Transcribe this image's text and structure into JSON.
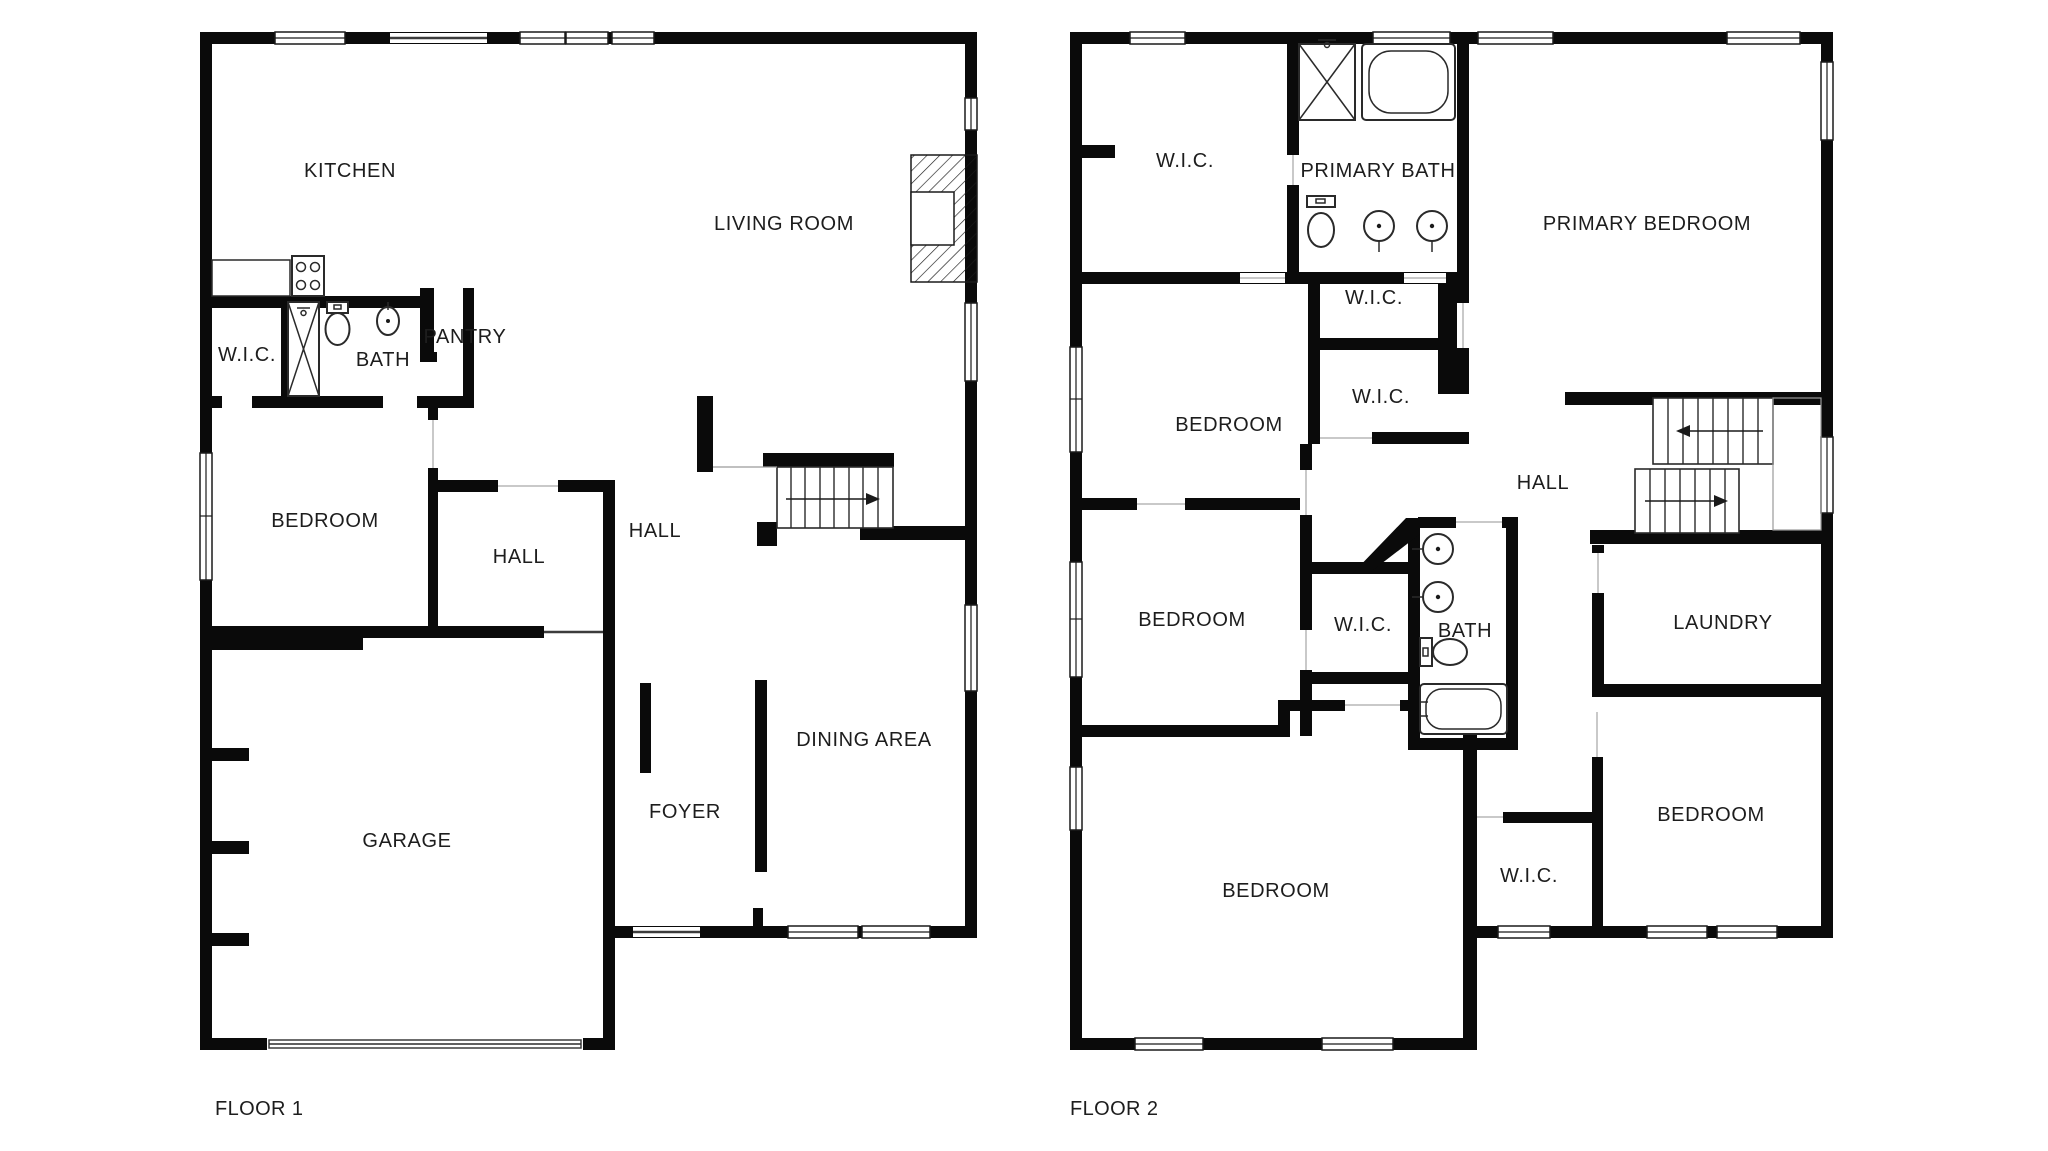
{
  "page": {
    "type": "floor-plan",
    "background": "#ffffff"
  },
  "colors": {
    "wall": "#0a0a0a",
    "text": "#1d1d1d",
    "window_line": "#1a1a1a",
    "threshold_line": "#c9c9c9"
  },
  "floors": [
    {
      "caption": "FLOOR 1",
      "rooms": [
        {
          "name": "KITCHEN",
          "x": 350,
          "y": 171
        },
        {
          "name": "LIVING ROOM",
          "x": 784,
          "y": 224
        },
        {
          "name": "W.I.C.",
          "x": 247,
          "y": 355
        },
        {
          "name": "BATH",
          "x": 383,
          "y": 360
        },
        {
          "name": "PANTRY",
          "x": 465,
          "y": 337
        },
        {
          "name": "BEDROOM",
          "x": 325,
          "y": 521
        },
        {
          "name": "HALL",
          "x": 519,
          "y": 557
        },
        {
          "name": "HALL",
          "x": 655,
          "y": 531
        },
        {
          "name": "DINING AREA",
          "x": 864,
          "y": 740
        },
        {
          "name": "FOYER",
          "x": 685,
          "y": 812
        },
        {
          "name": "GARAGE",
          "x": 407,
          "y": 841
        }
      ],
      "fixtures": [
        "stove",
        "kitchen-counter",
        "shower",
        "toilet",
        "sink",
        "fireplace",
        "staircase",
        "garage-door",
        "entry-door"
      ]
    },
    {
      "caption": "FLOOR 2",
      "rooms": [
        {
          "name": "W.I.C.",
          "x": 1185,
          "y": 161
        },
        {
          "name": "PRIMARY BATH",
          "x": 1378,
          "y": 171
        },
        {
          "name": "PRIMARY BEDROOM",
          "x": 1647,
          "y": 224
        },
        {
          "name": "W.I.C.",
          "x": 1374,
          "y": 298
        },
        {
          "name": "W.I.C.",
          "x": 1381,
          "y": 397
        },
        {
          "name": "BEDROOM",
          "x": 1229,
          "y": 425
        },
        {
          "name": "HALL",
          "x": 1543,
          "y": 483
        },
        {
          "name": "BEDROOM",
          "x": 1192,
          "y": 620
        },
        {
          "name": "W.I.C.",
          "x": 1363,
          "y": 625
        },
        {
          "name": "BATH",
          "x": 1465,
          "y": 631
        },
        {
          "name": "LAUNDRY",
          "x": 1723,
          "y": 623
        },
        {
          "name": "BEDROOM",
          "x": 1711,
          "y": 815
        },
        {
          "name": "W.I.C.",
          "x": 1529,
          "y": 876
        },
        {
          "name": "BEDROOM",
          "x": 1276,
          "y": 891
        }
      ],
      "fixtures": [
        "shower",
        "bathtub",
        "toilet",
        "double-sink",
        "sink",
        "toilet",
        "bathtub",
        "staircase"
      ]
    }
  ]
}
